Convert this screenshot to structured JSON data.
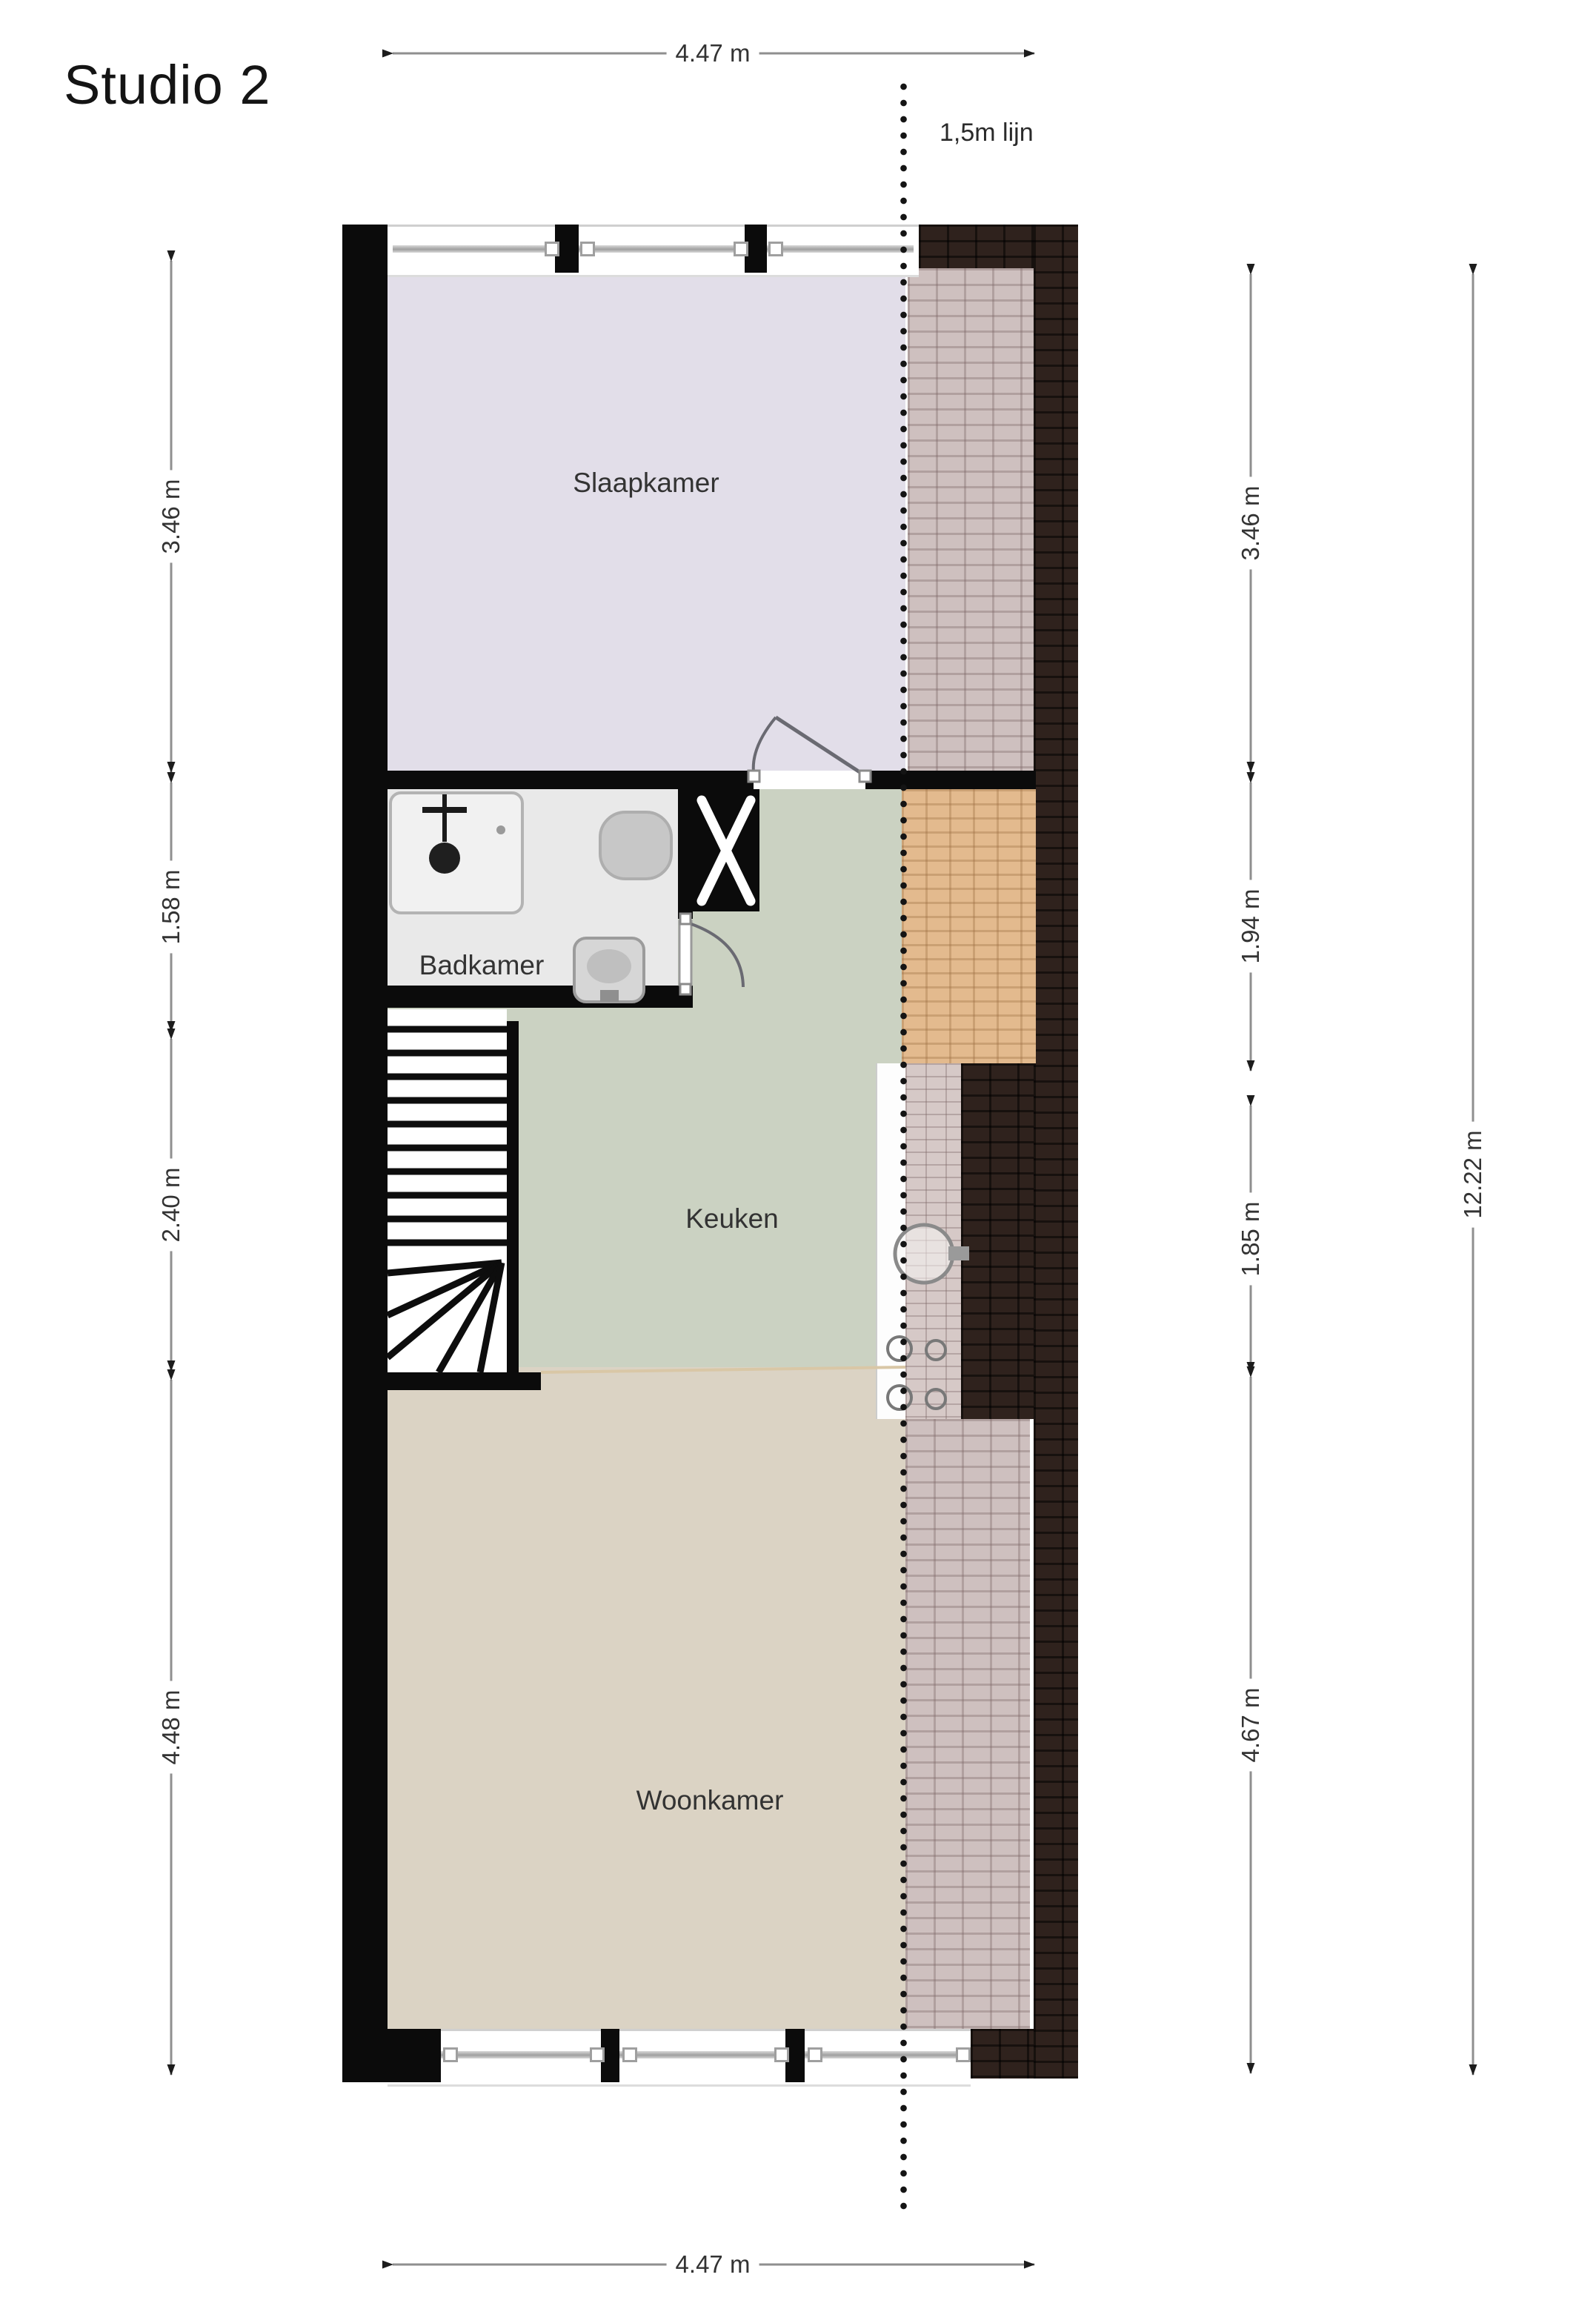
{
  "title": "Studio 2",
  "line_marker": {
    "label": "1,5m lijn"
  },
  "rooms": [
    {
      "name": "Slaapkamer"
    },
    {
      "name": "Badkamer"
    },
    {
      "name": "Keuken"
    },
    {
      "name": "Woonkamer"
    }
  ],
  "dimensions": {
    "top": {
      "label": "4.47 m"
    },
    "bottom": {
      "label": "4.47 m"
    },
    "left": [
      {
        "label": "3.46 m"
      },
      {
        "label": "1.58 m"
      },
      {
        "label": "2.40 m"
      },
      {
        "label": "4.48 m"
      }
    ],
    "right": [
      {
        "label": "3.46 m"
      },
      {
        "label": "1.94 m"
      },
      {
        "label": "1.85 m"
      },
      {
        "label": "4.67 m"
      }
    ],
    "total": {
      "label": "12.22 m"
    }
  },
  "colors": {
    "wall": "#0b0b0b",
    "slaapkamer": "#e2dee9",
    "badkamer": "#e9e9e9",
    "keuken": "#cbd2c2",
    "woonkamer": "#dbd3c4",
    "brick_dark": "#2f221d",
    "brick_pink": "#cec0bf",
    "brick_orange": "#e3ba8e",
    "tiles": "#d6c9c7",
    "dimension_line": "#8f8f8f",
    "dotted_line": "#141414"
  }
}
